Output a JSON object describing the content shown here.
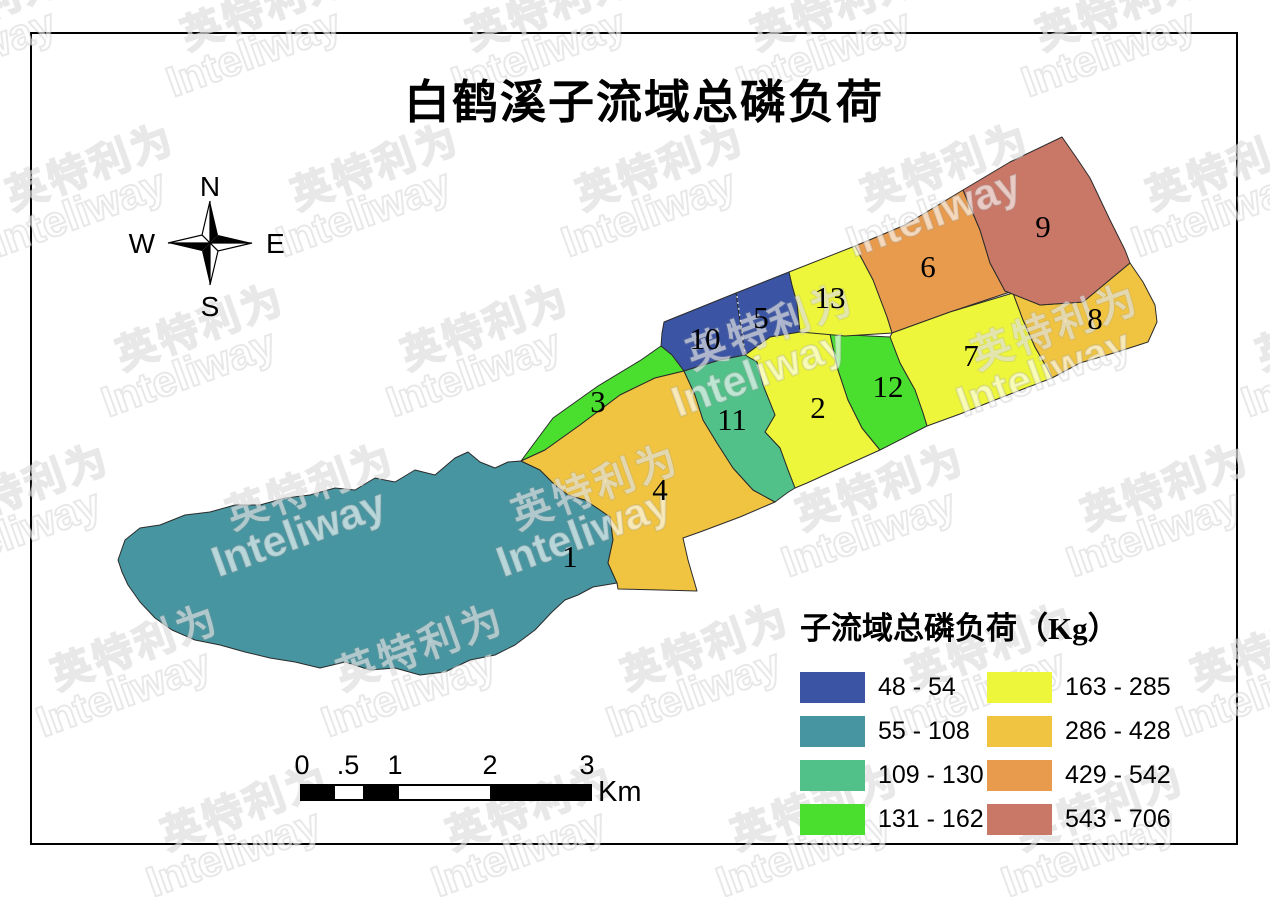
{
  "page": {
    "title": "白鹤溪子流域总磷负荷"
  },
  "compass": {
    "north": "N",
    "south": "S",
    "east": "E",
    "west": "W"
  },
  "map": {
    "regions": [
      {
        "id": "1",
        "range": "55 - 108",
        "color": "#4695A0"
      },
      {
        "id": "2",
        "range": "163 - 285",
        "color": "#EDF63B"
      },
      {
        "id": "3",
        "range": "131 - 162",
        "color": "#4ADF2E"
      },
      {
        "id": "4",
        "range": "286 - 428",
        "color": "#F0C441"
      },
      {
        "id": "5",
        "range": "48 - 54",
        "color": "#3B55A4"
      },
      {
        "id": "6",
        "range": "429 - 542",
        "color": "#E89B4C"
      },
      {
        "id": "7",
        "range": "163 - 285",
        "color": "#EDF63B"
      },
      {
        "id": "8",
        "range": "286 - 428",
        "color": "#F0C441"
      },
      {
        "id": "9",
        "range": "543 - 706",
        "color": "#C97767"
      },
      {
        "id": "10",
        "range": "48 - 54",
        "color": "#3B55A4"
      },
      {
        "id": "11",
        "range": "109 - 130",
        "color": "#52C189"
      },
      {
        "id": "12",
        "range": "131 - 162",
        "color": "#4ADF2E"
      },
      {
        "id": "13",
        "range": "163 - 285",
        "color": "#EDF63B"
      }
    ]
  },
  "legend": {
    "title": "子流域总磷负荷（Kg）",
    "items": [
      {
        "label": "48 - 54",
        "color": "#3B55A4"
      },
      {
        "label": "55 - 108",
        "color": "#4695A0"
      },
      {
        "label": "109 - 130",
        "color": "#52C189"
      },
      {
        "label": "131 - 162",
        "color": "#4ADF2E"
      },
      {
        "label": "163 - 285",
        "color": "#EDF63B"
      },
      {
        "label": "286 - 428",
        "color": "#F0C441"
      },
      {
        "label": "429 - 542",
        "color": "#E89B4C"
      },
      {
        "label": "543 - 706",
        "color": "#C97767"
      }
    ]
  },
  "scalebar": {
    "labels": [
      "0",
      ".5",
      "1",
      "2",
      "3"
    ],
    "unit": "Km"
  },
  "watermark": {
    "cn": "英特利为",
    "en": "Inteliway"
  }
}
